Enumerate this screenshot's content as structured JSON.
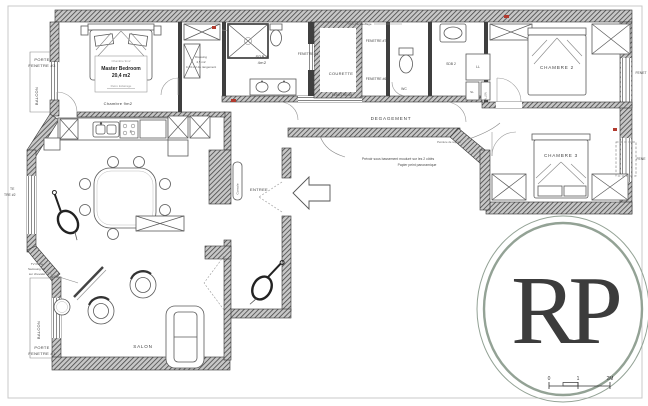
{
  "labels": {
    "porte_fenetre3_1": "PORTE",
    "porte_fenetre3_2": "FENETRE #3",
    "balcon_top": "BALCON",
    "chambre9_note": "Chambre 9m2",
    "master_bedroom": "Master Bedroom",
    "master_area": "20,4 m2",
    "retro_eclairage": "Retro Eclairage",
    "chambre9": "Chambre 9m2",
    "dressing_1": "Dressing",
    "dressing_2": "4,5 m2",
    "dressing_3": "4,23 m2 de rangement",
    "sdb1_1": "SDB 1",
    "sdb1_2": "4m2",
    "fenetre4": "FENETRE #4",
    "puit": "Puit d'échauffage",
    "fenetre7": "FENETRE #7",
    "courette": "COURETTE",
    "fenetre6": "FENETRE #6",
    "fenetre5": "FENETRE #5",
    "wc": "WC",
    "sdb2": "SDB 2",
    "ll": "LL",
    "sl": "SL",
    "ballon": "BALLON",
    "chambre2": "CHAMBRE 2",
    "fenet_top": "FENET",
    "degagement": "DEGAGEMENT",
    "reprise": "Peinture de reprise",
    "chambre3": "CHAMBRE 3",
    "fenet_mid": "FENE",
    "note_1": "Prévoir sous bassement mouluré sur les 2 côtés",
    "note_2": "Papier peint panoramique",
    "entree": "ENTREE",
    "console": "Console",
    "tv_1": "TV frame",
    "tv_2": "Samsung 55\"",
    "tv_3": "sur chevalet",
    "balcon_bottom": "BALCON",
    "porte_fenetre1_1": "PORTE",
    "porte_fenetre1_2": "FENETRE #1",
    "salon": "SALON",
    "fenetre2_frag_1": "TE",
    "fenetre2_frag_2": "TRE #2",
    "stove_f": "F"
  },
  "logo": {
    "initials": "RP"
  },
  "scale_bar": {
    "zero": "0",
    "one": "1",
    "two": "2M"
  },
  "colors": {
    "logo_green": "#93a295",
    "wall_dark": "#3f3f3f",
    "accent_red": "#b23a2e"
  }
}
